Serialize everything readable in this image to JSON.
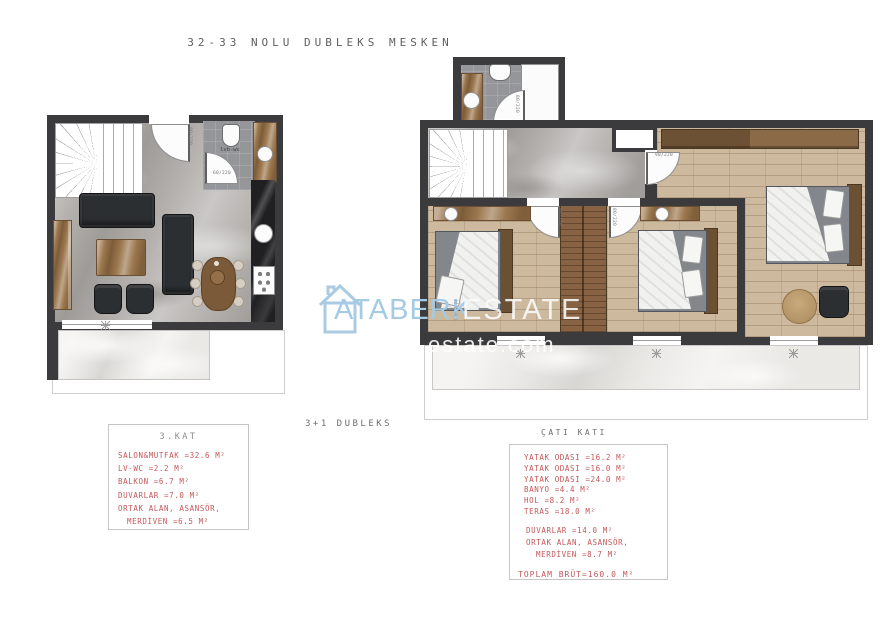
{
  "title": "32-33 NOLU DUBLEKS MESKEN",
  "center_label": "3+1 DUBLEKS",
  "floor3": {
    "header": "3.KAT",
    "lines": [
      "SALON&MUTFAK =32.6 M²",
      "LV-WC =2.2 M²",
      "BALKON =6.7 M²",
      "DUVARLAR =7.0 M²",
      "ORTAK ALAN, ASANSÖR,",
      "MERDİVEN =6.5 M²"
    ]
  },
  "roof": {
    "header": "ÇATI KATI",
    "rooms": [
      "YATAK ODASI =16.2 M²",
      "YATAK ODASI =16.0 M²",
      "YATAK ODASI =24.0 M²",
      "BANYO =4.4 M²",
      "HOL =8.2 M²",
      "TERAS =18.0 M²"
    ],
    "common": [
      "DUVARLAR =14.0 M²",
      "ORTAK ALAN, ASANSÖR,",
      "MERDİVEN =8.7 M²"
    ],
    "total": "TOPLAM BRÜT=160.0 M²"
  },
  "annotations": {
    "wc": "lvb-wc",
    "door_80": "80/220",
    "door_60": "60/220",
    "door_90": "90/220"
  },
  "watermark": {
    "brand": "ATABERK",
    "real": "REAL",
    "estate": "ESTATE",
    "domain": "estate.com"
  },
  "colors": {
    "wall": "#3b3b3d",
    "red_text": "#c4585c",
    "gray_text": "#8c8c8c",
    "watermark_blue": "#a6c9e2"
  }
}
